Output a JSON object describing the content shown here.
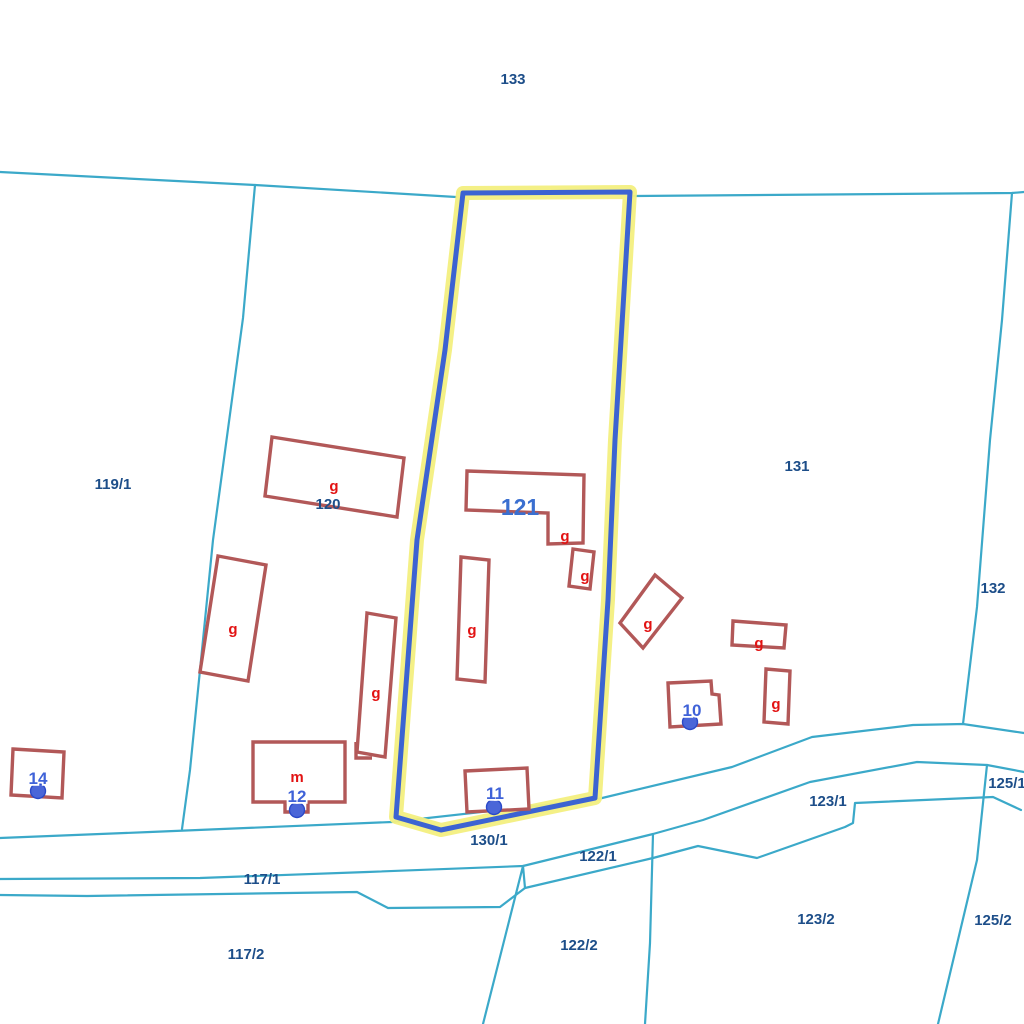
{
  "map": {
    "parcel_labels": [
      {
        "text": "133"
      },
      {
        "text": "119/1"
      },
      {
        "text": "120"
      },
      {
        "text": "131"
      },
      {
        "text": "132"
      },
      {
        "text": "130/1"
      },
      {
        "text": "117/1"
      },
      {
        "text": "117/2"
      },
      {
        "text": "122/1"
      },
      {
        "text": "122/2"
      },
      {
        "text": "123/1"
      },
      {
        "text": "123/2"
      },
      {
        "text": "125/1"
      },
      {
        "text": "125/2"
      }
    ],
    "highlighted_parcel": {
      "label": "121"
    },
    "building_letters": [
      {
        "text": "g"
      },
      {
        "text": "g"
      },
      {
        "text": "g"
      },
      {
        "text": "g"
      },
      {
        "text": "g"
      },
      {
        "text": "g"
      },
      {
        "text": "g"
      },
      {
        "text": "g"
      },
      {
        "text": "g"
      },
      {
        "text": "m"
      }
    ],
    "house_numbers": [
      {
        "text": "14"
      },
      {
        "text": "12"
      },
      {
        "text": "11"
      },
      {
        "text": "10"
      }
    ],
    "colors": {
      "background": "#FFFFFF",
      "boundary": "#3BA9C9",
      "building_outline": "#B25858",
      "building_letter": "#E21212",
      "parcel_label": "#1D4E89",
      "selected_parcel_label": "#3A6FD0",
      "house_number": "#3F62D8",
      "house_number_dot": "#4A66D8",
      "highlight_halo": "#F3EF80",
      "highlight_outline": "#3C63D2"
    }
  }
}
